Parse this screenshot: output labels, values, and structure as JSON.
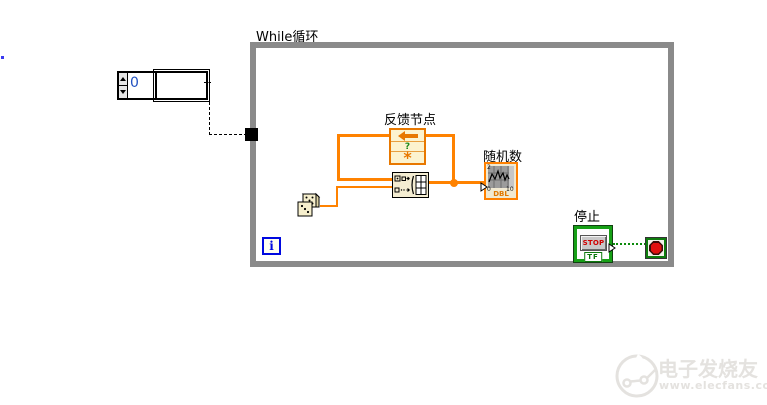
{
  "while_loop": {
    "label": "While循环",
    "border_color": "#8a8a8a",
    "iteration_terminal": {
      "label": "i",
      "color": "#0009e0"
    },
    "condition_terminal": {
      "border_color": "#0e7c0e",
      "stop_sign_color": "#e01010"
    }
  },
  "numeric_control": {
    "value": "0",
    "value_color": "#2050c0"
  },
  "feedback_node": {
    "label": "反馈节点",
    "border_color": "#e87800",
    "cells": {
      "question": "?",
      "initializer": "*"
    }
  },
  "chart": {
    "label": "随机数",
    "type_label": "DBL",
    "border_color": "#ff8000",
    "ticks": {
      "y_top": "2",
      "y_bottom": "0",
      "x_max": "10"
    }
  },
  "stop_button": {
    "label": "停止",
    "button_text": "STOP",
    "type_label": "TF"
  },
  "wires": {
    "array_color": "#ff8200",
    "scalar_color": "#ff8200",
    "boolean_color": "#0c8a0c",
    "broken_color": "#000000"
  },
  "watermark": {
    "title": "电子发烧友",
    "url": "www.elecfans.com",
    "color": "#e4e2df"
  }
}
